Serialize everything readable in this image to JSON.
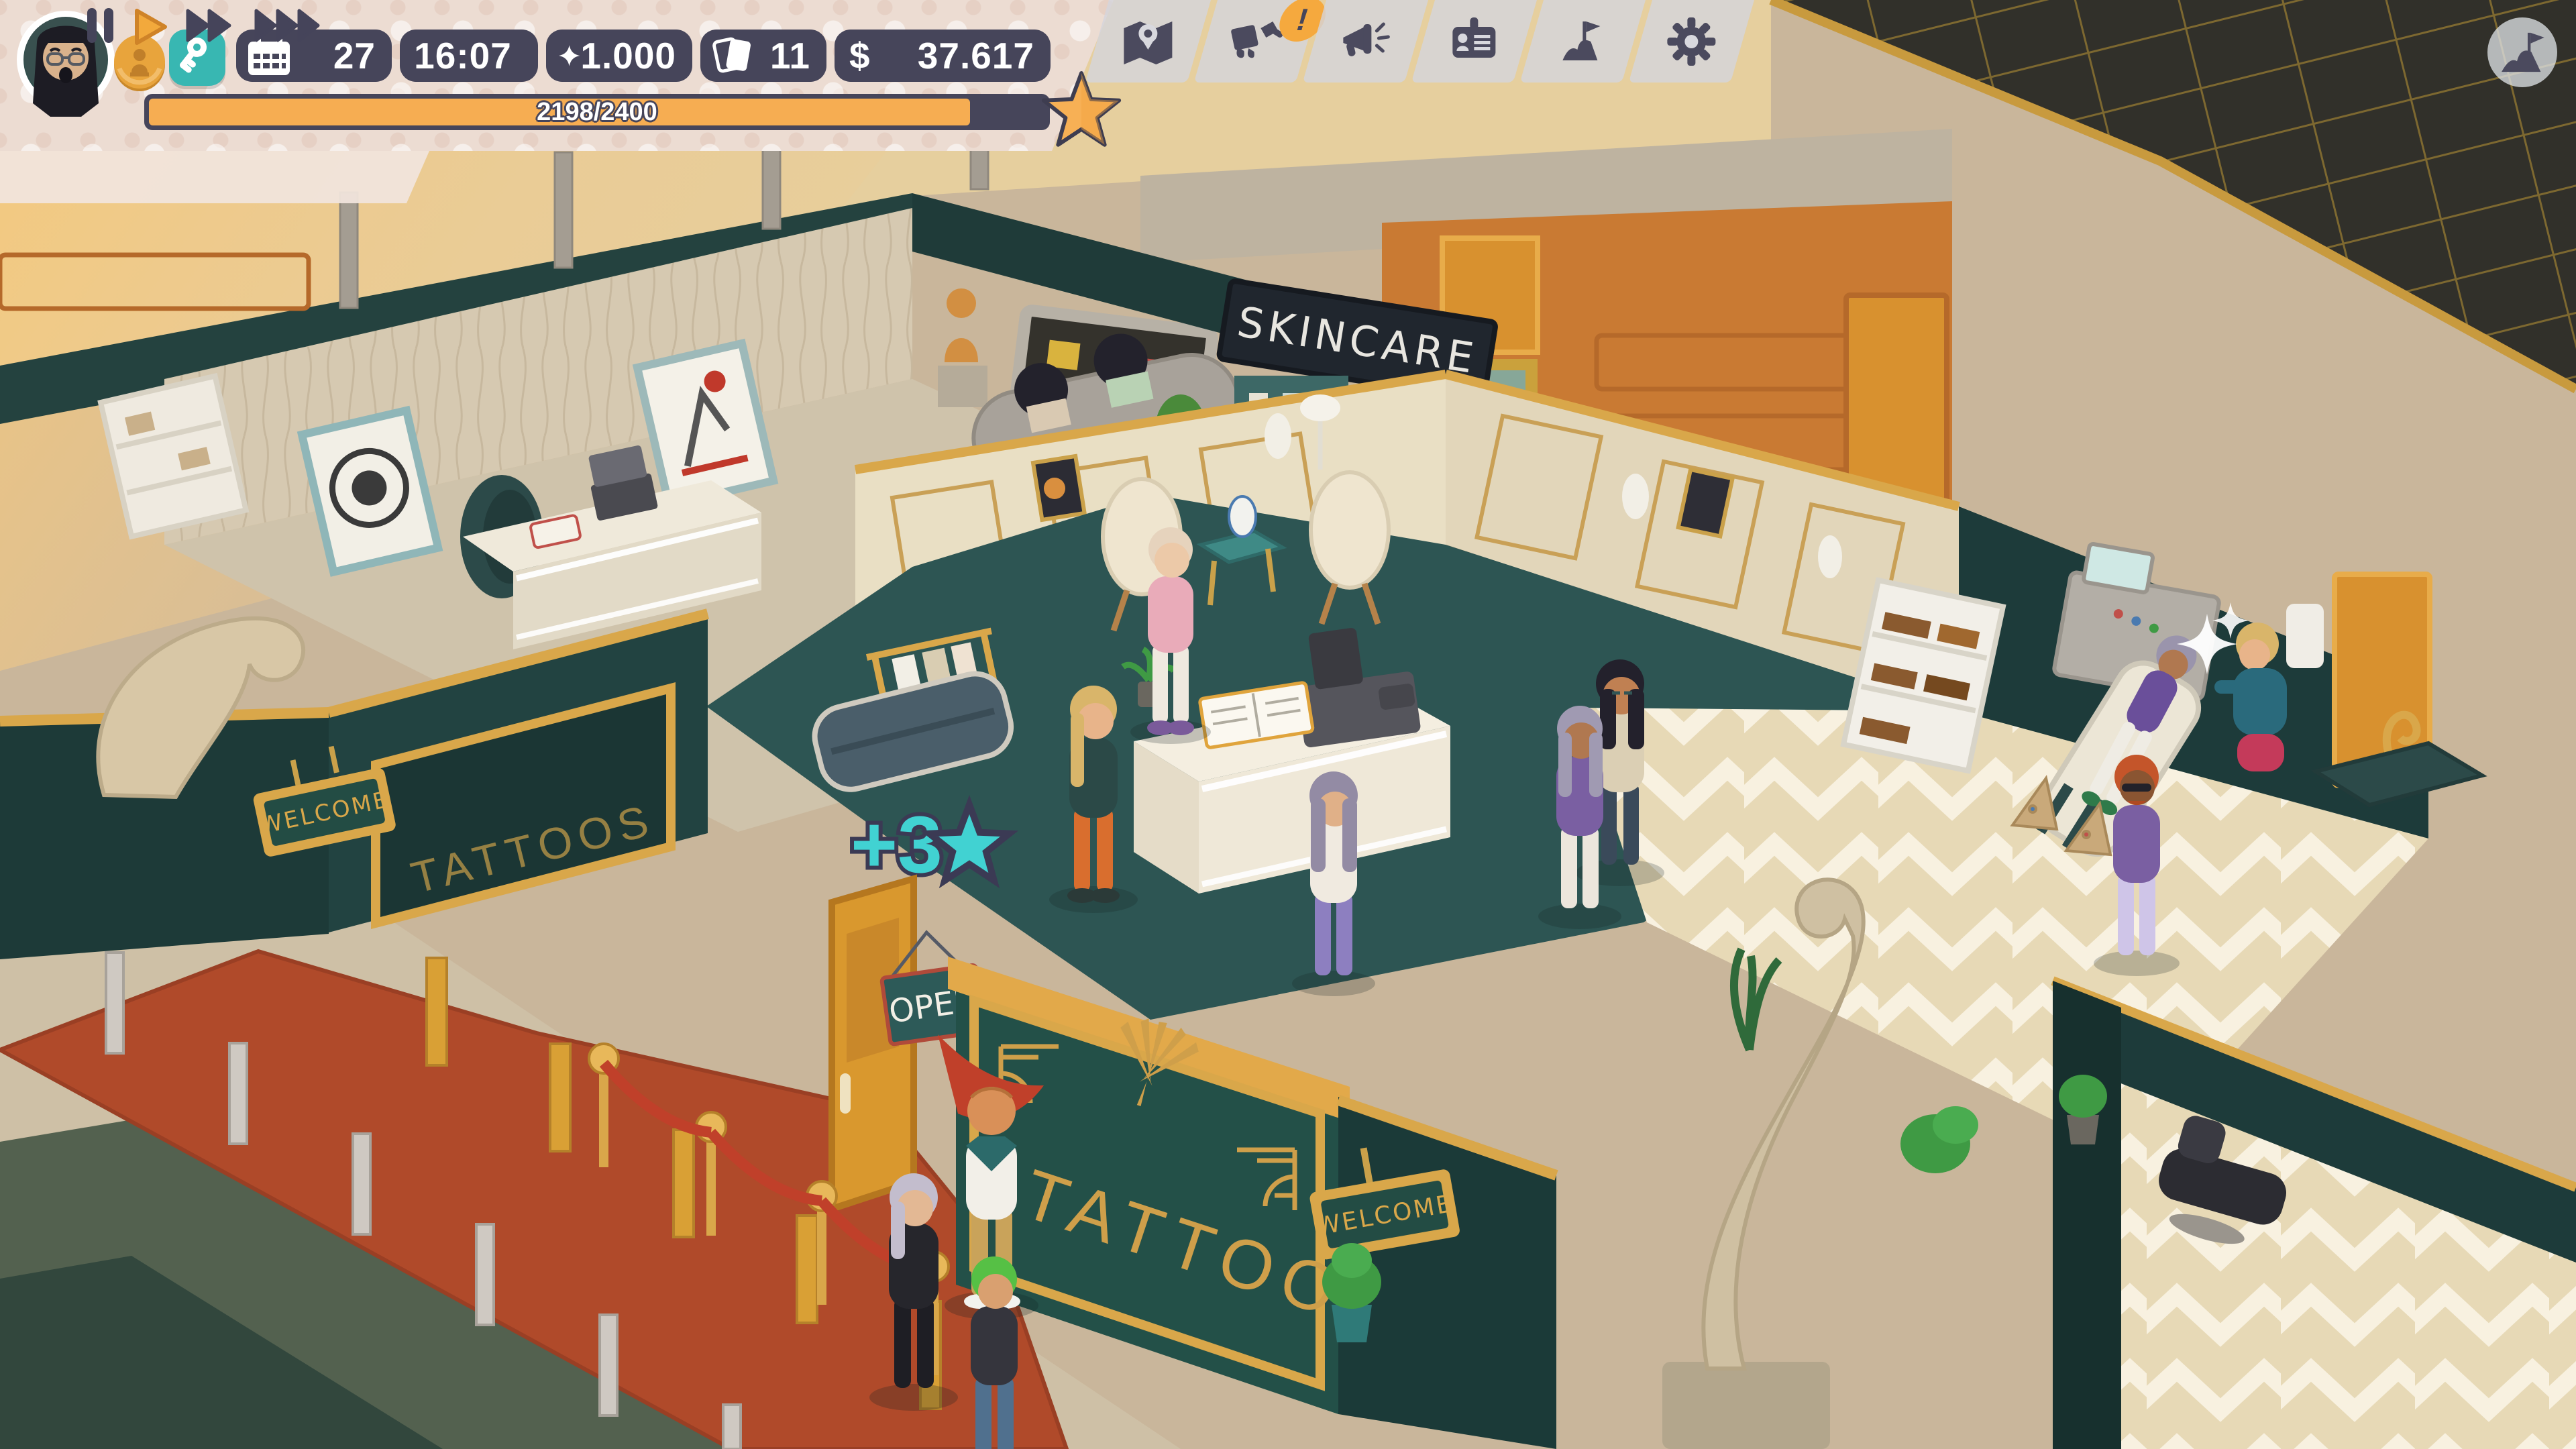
{
  "hud": {
    "player": {
      "avatar": "woman-dark-hair-glasses"
    },
    "resources": {
      "medal_icon": "medal-coin-icon",
      "key_icon": "key-icon",
      "day": "27",
      "time": "16:07",
      "stars": "1.000",
      "cards": "11",
      "currency_symbol": "$",
      "money": "37.617"
    },
    "xp": {
      "label": "2198/2400",
      "current": 2198,
      "max": 2400,
      "percent": 91.6,
      "star_icon": "star-icon"
    },
    "speed": {
      "active": "play",
      "buttons": [
        "pause",
        "play",
        "fast-forward",
        "fastest-forward"
      ]
    },
    "toolbar": {
      "items": [
        {
          "name": "map",
          "icon": "map-icon",
          "badge": ""
        },
        {
          "name": "decorate",
          "icon": "paint-decor-icon",
          "badge": "!"
        },
        {
          "name": "marketing",
          "icon": "megaphone-icon",
          "badge": ""
        },
        {
          "name": "staff",
          "icon": "id-card-icon",
          "badge": ""
        },
        {
          "name": "goals",
          "icon": "flag-icon",
          "badge": ""
        },
        {
          "name": "settings",
          "icon": "gear-icon",
          "badge": ""
        }
      ]
    },
    "milestones_button": {
      "icon": "mountain-flag-icon"
    }
  },
  "scene": {
    "signs": {
      "skincare": "SKINCARE",
      "tattoos_front": "TATTOOS",
      "tattoos_side": "TATTOOS",
      "open": "OPEN",
      "welcome_left": "WELCOME",
      "welcome_entrance": "WELCOME"
    },
    "popups": {
      "xp_gain": "+3"
    },
    "colors": {
      "accent_orange": "#f2a93c",
      "hud_navy": "#46455a",
      "teal_accent": "#38b7b2",
      "floor_teal": "#2d5553",
      "gold": "#d9a74a",
      "carpet_red": "#b04a2a"
    }
  }
}
